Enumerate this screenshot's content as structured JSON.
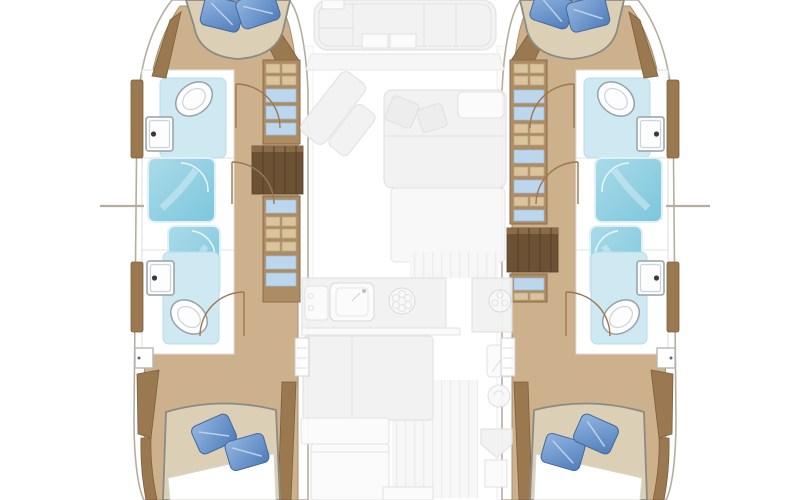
{
  "palette": {
    "bg": "#ffffff",
    "hull-outline": "#b5ada0",
    "wood-floor": "#cdb08c",
    "wood-floor-line": "#a8916f",
    "wood-trim": "#9a7850",
    "wood-dark": "#6d5134",
    "cabinet": "#ad8c63",
    "item-blue": "#bcd6ee",
    "item-tan": "#d9c49d",
    "mattress": "#dbcfb6",
    "mattress-line": "#8b8b85",
    "pillow-light": "#93b6e0",
    "pillow-dark": "#4e7cba",
    "bath-floor": "#cfe9f2",
    "shower-hi": "#aadbe9",
    "shower-lo": "#7cc6dc",
    "fixture-stroke": "#96a1a7",
    "ghost-fill": "#f2f2f2",
    "ghost-line": "#e2e2e2"
  },
  "regions": {
    "port_hull": {
      "forward_cabin": {
        "bed": "island-berth",
        "pillow_count": 2
      },
      "forward_head": {
        "fixtures": [
          "toilet",
          "sink",
          "door-swing"
        ]
      },
      "shower_count": 2,
      "aft_head": {
        "fixtures": [
          "toilet",
          "sink",
          "door-swing"
        ]
      },
      "aft_cabin": {
        "bed": "double-berth",
        "pillow_count": 2
      },
      "wardrobe_lockers": 2,
      "companionway_steps": 1,
      "deck_hatch": 1
    },
    "starboard_hull": {
      "forward_cabin": {
        "bed": "island-berth",
        "pillow_count": 2
      },
      "forward_head": {
        "fixtures": [
          "toilet",
          "sink",
          "door-swing"
        ]
      },
      "shower_count": 2,
      "aft_head": {
        "fixtures": [
          "toilet",
          "sink",
          "door-swing"
        ]
      },
      "aft_cabin": {
        "bed": "double-berth",
        "pillow_count": 2
      },
      "wardrobe_lockers": 2,
      "companionway_steps": 1,
      "deck_hatch": 1
    },
    "center_deck": {
      "foredeck_seating": "lounge-cluster",
      "saloon": {
        "furniture": [
          "chaise",
          "sofa",
          "cushions",
          "table"
        ]
      },
      "galley": {
        "fixtures": [
          "sink",
          "burner",
          "burner",
          "counter",
          "island"
        ]
      },
      "aft_cockpit": {
        "features": [
          "bench",
          "helm-seat",
          "plank-decking"
        ]
      }
    }
  }
}
